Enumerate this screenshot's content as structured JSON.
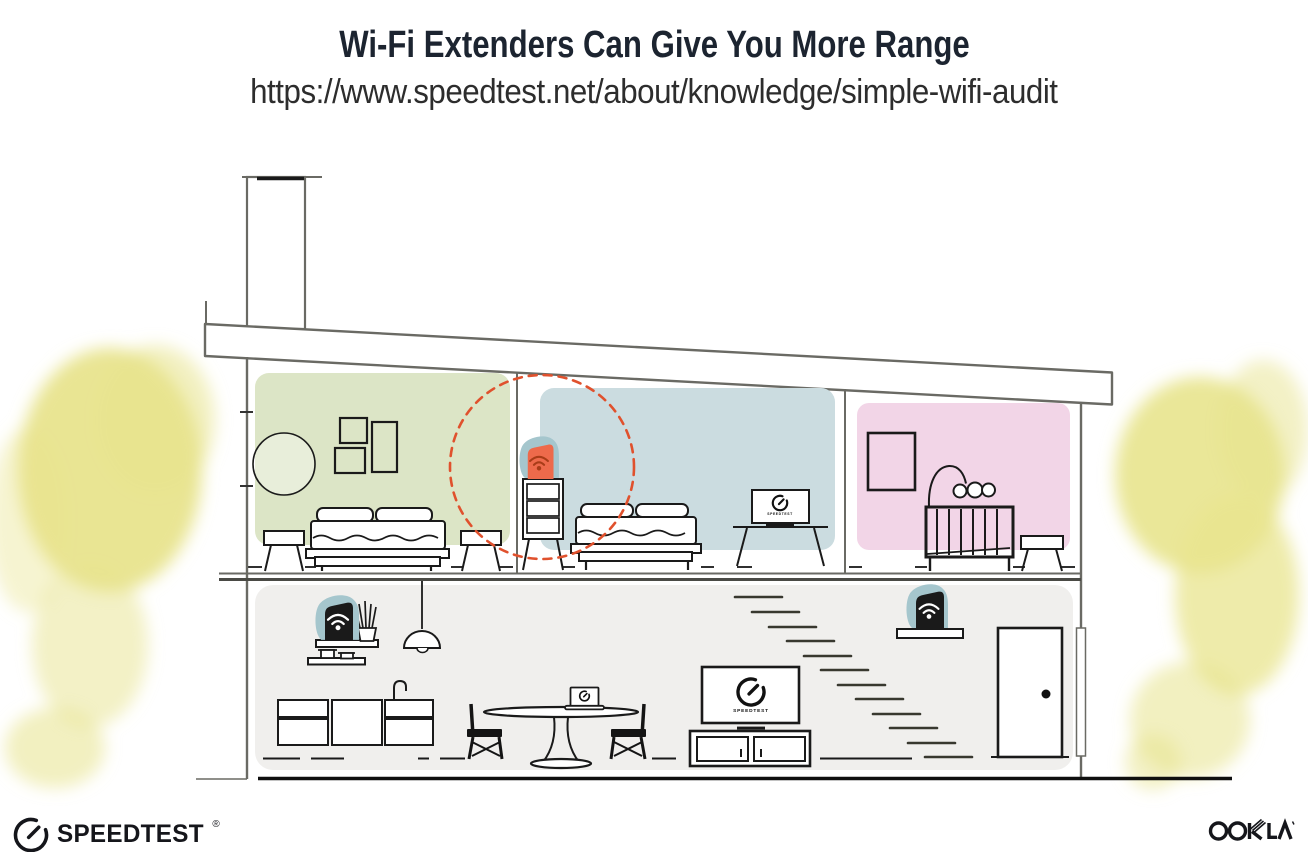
{
  "header": {
    "title": "Wi-Fi Extenders Can Give You More Range",
    "url": "https://www.speedtest.net/about/knowledge/simple-wifi-audit"
  },
  "illustration": {
    "tv_screen_label": "SPEEDTEST"
  },
  "colors": {
    "room_green": "#dce5c6",
    "room_blue": "#cbdce0",
    "room_pink": "#f2d5e7",
    "downstairs_gray": "#f0efed",
    "device_teal": "#a5c6cd",
    "extender_orange": "#ed6a4b",
    "extender_wifi_rust": "#a83c18",
    "wifi_white": "#ffffff",
    "range_dash_red": "#e0512d",
    "foliage_yellow": "#e8e48d",
    "foliage_yellow_light": "#efecA4",
    "ink": "#1a1a1a",
    "structure_gray": "#6a6a64"
  },
  "footer": {
    "speedtest_label": "SPEEDTEST",
    "reg_mark": "®",
    "ookla_label": "OOKLA"
  }
}
